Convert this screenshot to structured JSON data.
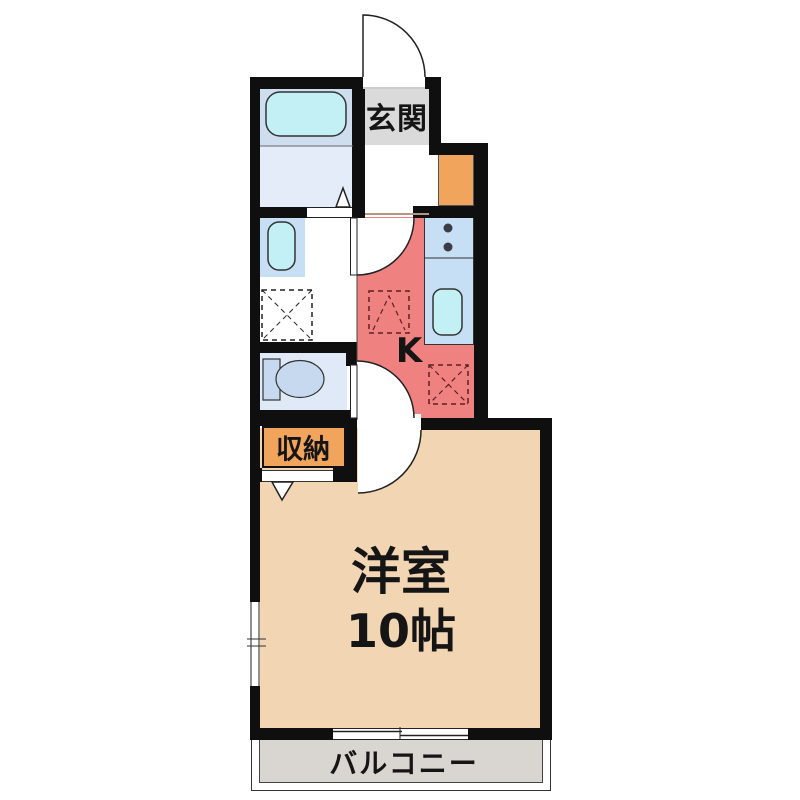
{
  "floorplan": {
    "type": "apartment-1K-floor-plan",
    "rooms": {
      "entrance": {
        "label": "玄関"
      },
      "kitchen": {
        "label": "K"
      },
      "storage": {
        "label": "収納"
      },
      "main_room": {
        "label": "洋室",
        "size": "10帖"
      },
      "balcony": {
        "label": "バルコニー"
      }
    },
    "icons": {
      "bathtub": "rounded-rect-tub",
      "washbasin": "rounded-rect-basin",
      "toilet": "tank-and-bowl",
      "kitchen_sink": "rounded-rect-sink",
      "stove_burners": "two-dots",
      "washing_machine_space": "dashed-square-x",
      "appliance_space_upper": "dashed-square-peak",
      "appliance_space_lower": "dashed-square-x",
      "hinged_doors": "quarter-circle-swing",
      "folding_doors": "triangle-marker",
      "sliding_window": "offset-double-line"
    },
    "colors": {
      "wall": "#0f0f0f",
      "kitchen_floor": "#f08181",
      "main_room_floor": "#f2d6b4",
      "balcony_floor": "#d9d5d0",
      "entrance_floor": "#dadada",
      "storage_fill": "#f0a45c",
      "bath_upper": "#cfdeef",
      "bath_lower": "#e3ecf8",
      "fixture_area_blue": "#c6dff4",
      "water_fixture_cyan": "#c2f0f4",
      "toilet_room_floor": "#dfe9f7"
    }
  }
}
